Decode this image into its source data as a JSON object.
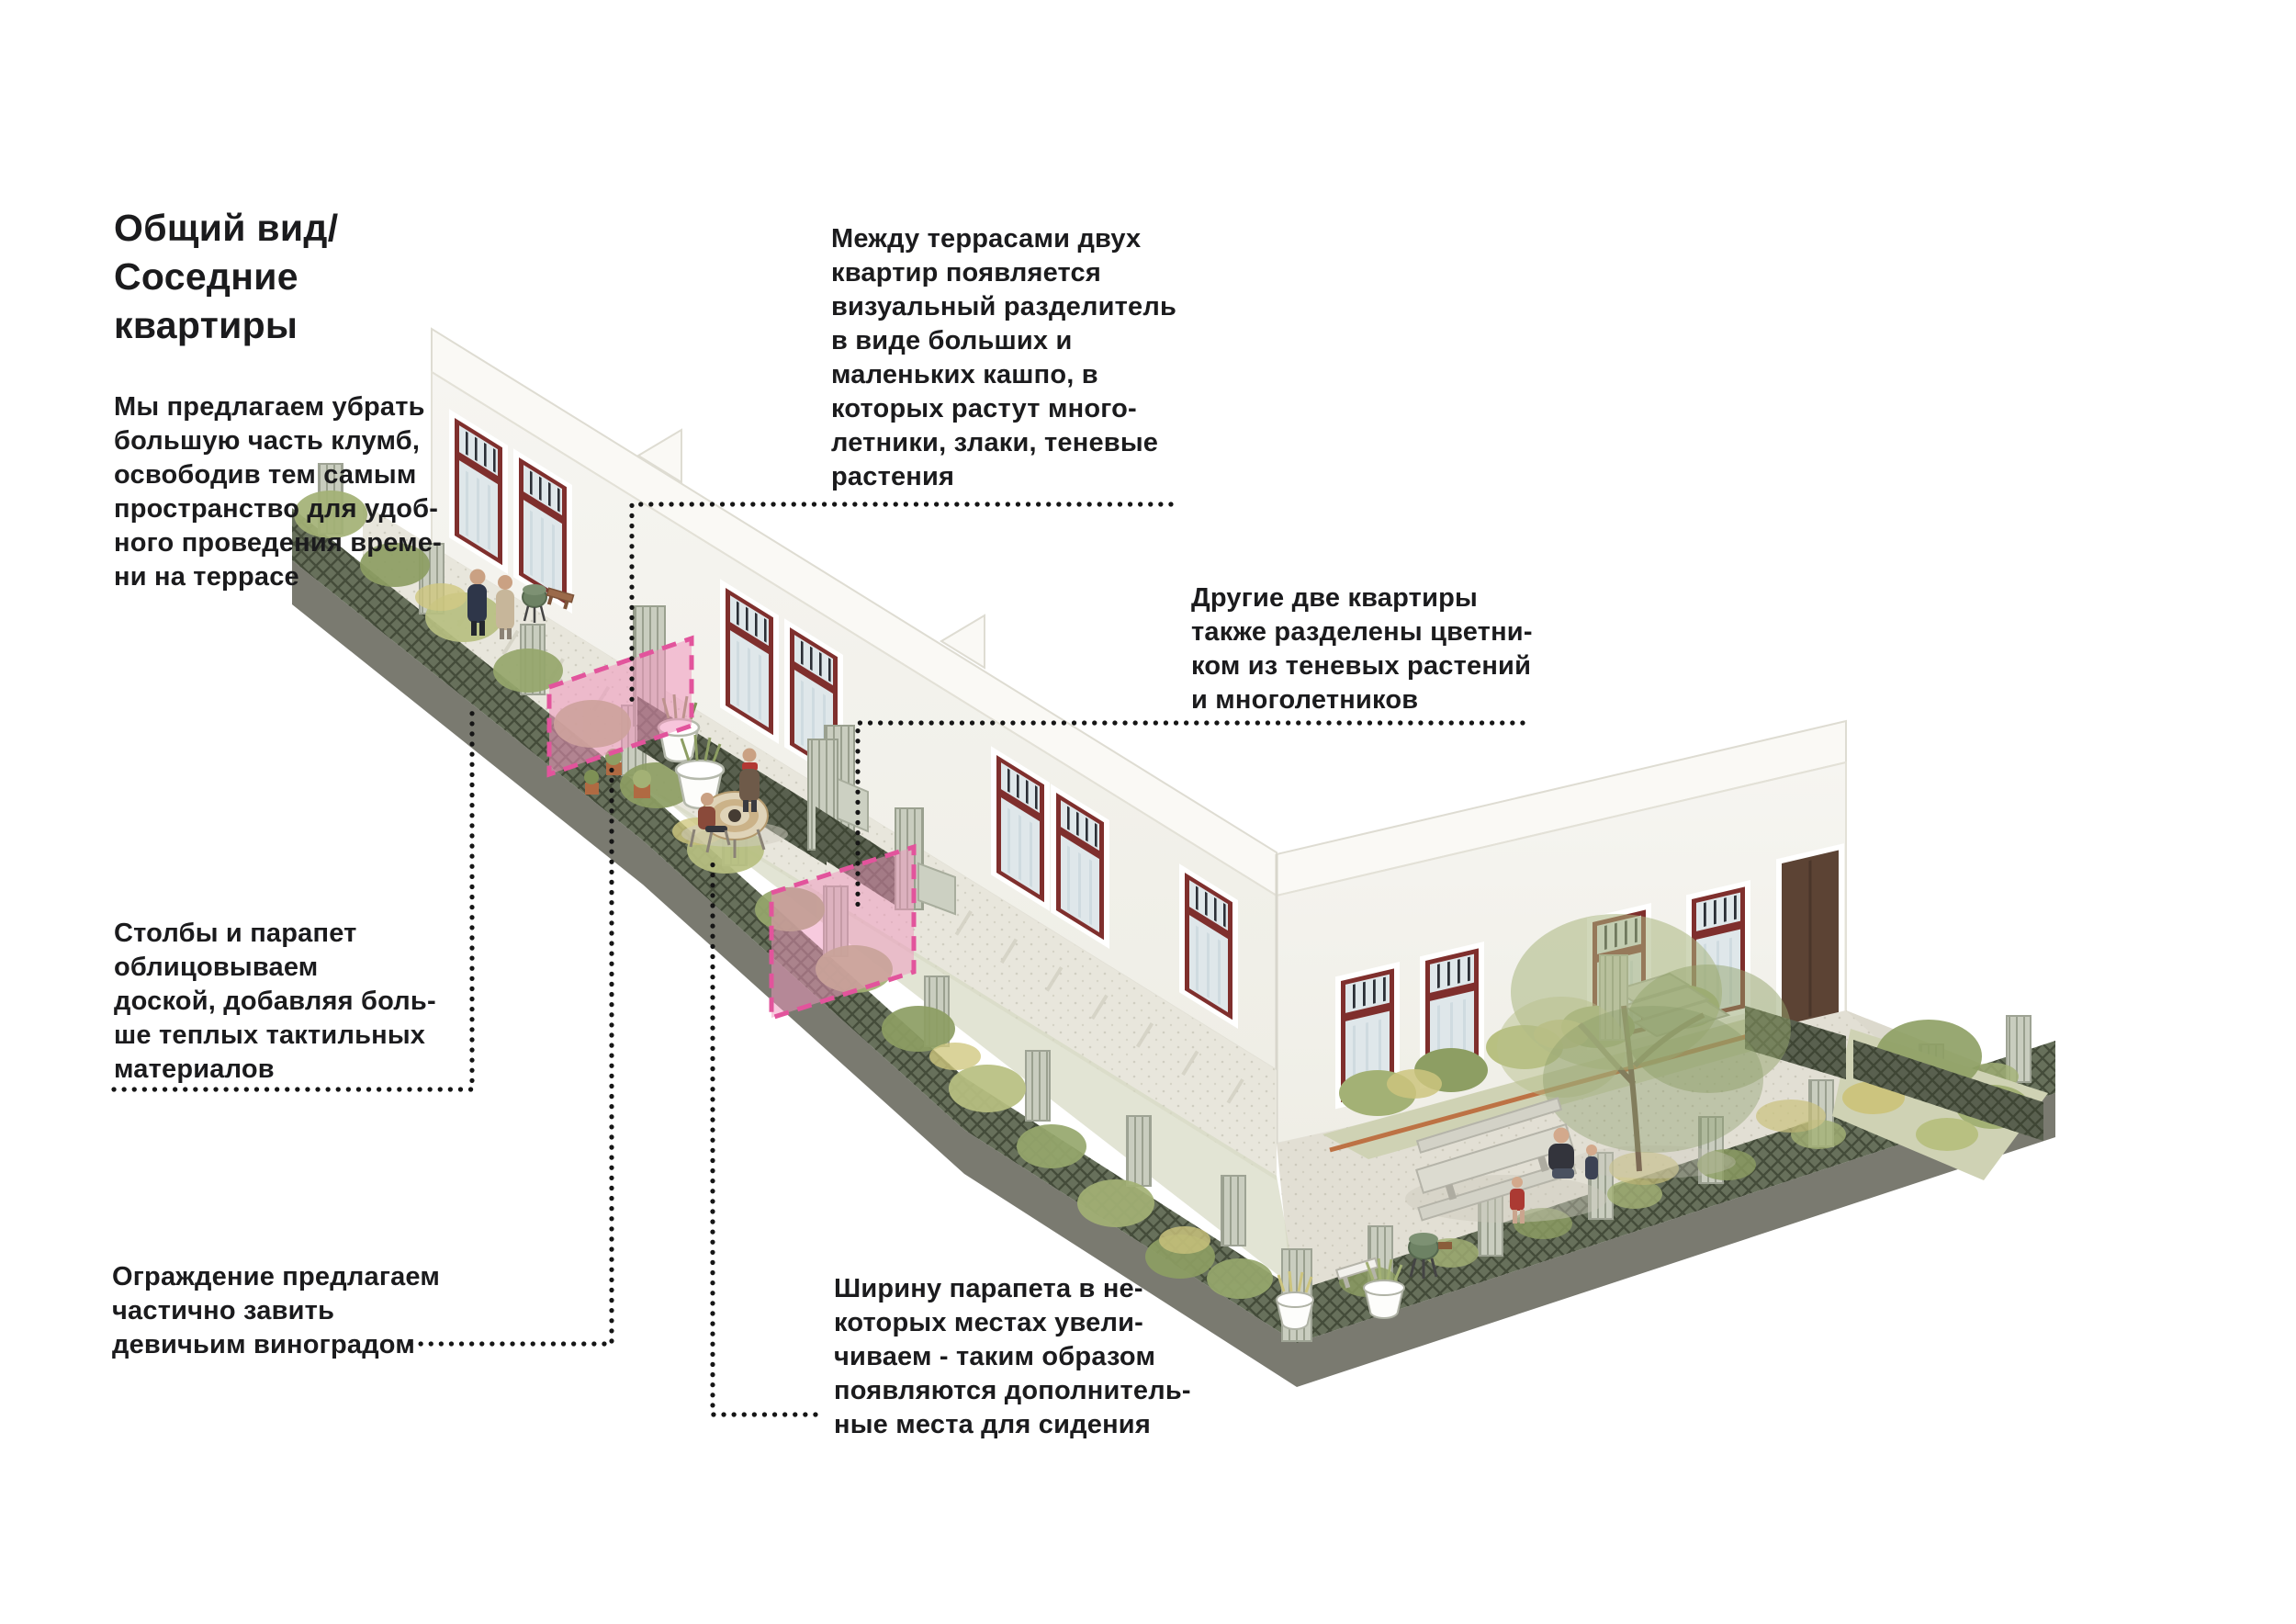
{
  "title": {
    "text": "Общий вид/\nСоседние\nквартиры"
  },
  "notes": [
    {
      "id": "remove-flowerbeds",
      "text": "Мы предлагаем убрать\nбольшую часть клумб,\nосвободив тем самым\nпространство для удоб-\nного проведения време-\nни на террасе"
    },
    {
      "id": "planter-divider",
      "text": "Между террасами двух\nквартир появляется\nвизуальный разделитель\nв виде больших и\nмаленьких кашпо, в\nкоторых растут много-\nлетники, злаки, теневые\nрастения"
    },
    {
      "id": "flowerbed-divider",
      "text": "Другие две квартиры\nтакже разделены цветни-\nком из теневых растений\nи многолетников"
    },
    {
      "id": "parapet-cladding",
      "text": "Столбы и парапет\nоблицовываем\nдоской, добавляя боль-\nше теплых тактильных\nматериалов"
    },
    {
      "id": "fence-vines",
      "text": "Ограждение предлагаем\nчастично завить\nдевичьим виноградом"
    },
    {
      "id": "parapet-width",
      "text": "Ширину парапета в не-\nкоторых местах увели-\nчиваем - таким образом\nпоявляются дополнитель-\nные места для сидения"
    }
  ],
  "colors": {
    "text": "#1b1b1d",
    "leader": "#161616",
    "pink-fill": "#f096be",
    "pink-stroke": "#e2549c",
    "wall": "#f4f3ee",
    "maroon": "#7f2f2d",
    "glass": "#dfe7ea"
  },
  "illustration": {
    "type": "axonometric courtyard diagram",
    "highlights": [
      "pink-divider-panel",
      "pink-flowerbed-panel"
    ]
  }
}
